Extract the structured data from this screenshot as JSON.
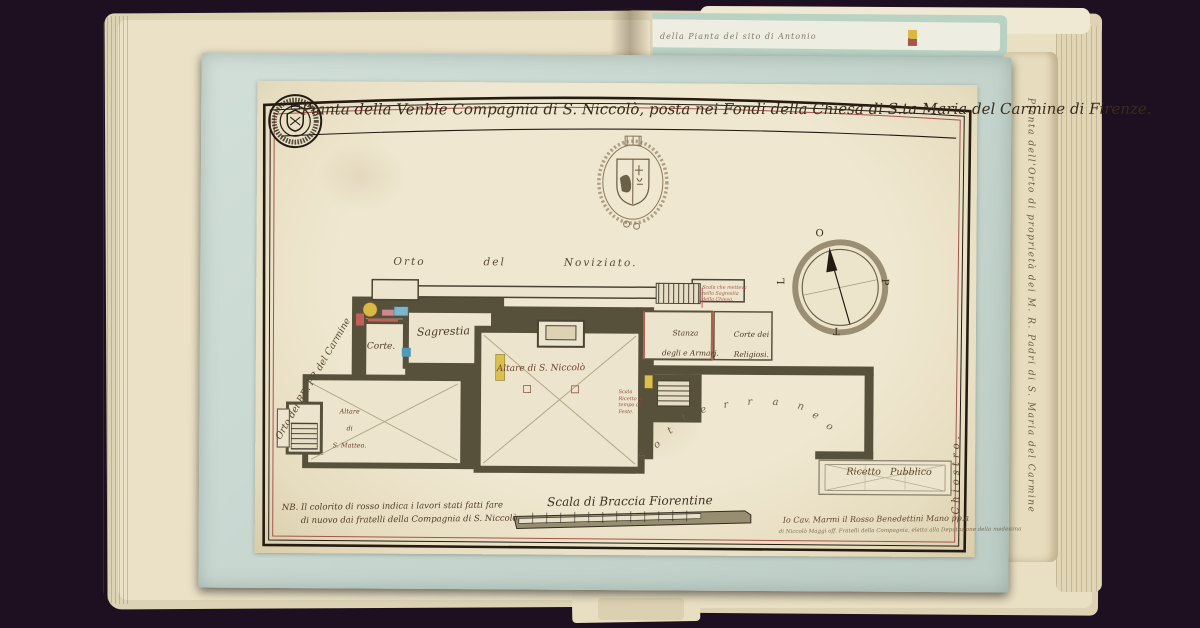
{
  "artwork": {
    "title": "Pianta della Venble Compagnia di S. Niccolò, posta nei Fondi della Chiesa di S.ta Maria del Carmine di Firenze."
  },
  "plan": {
    "rooms": {
      "sagrestia": "Sagrestia",
      "corte": "Corte.",
      "altare_niccolo": "Altare di S. Niccolò",
      "altare_matteo": [
        "Altare",
        "di",
        "S. Matteo."
      ],
      "stanza_armarj": [
        "Stanza",
        "degli e Armarj."
      ],
      "corte_religiosi": [
        "Corte dei",
        "Religiosi."
      ],
      "ricetto_pubblico": "Ricetto   Pubblico"
    },
    "areas": {
      "orto_noviziato": "Orto   del   Noviziato.",
      "orto_carmine": "Orto dei RR. PP. del Carmine",
      "sotterraneo": "Sotterraneo",
      "chiostro": "Chiostro."
    },
    "notes": {
      "scala_sagrestia": [
        "Scala che metteva",
        "nella Sagrestia",
        "della Chiesa."
      ],
      "ricetto_feste": [
        "Scala",
        "Ricetto in",
        "tempo di",
        "Feste."
      ]
    }
  },
  "compass": {
    "top": "O",
    "right": "P",
    "bottom": "T",
    "left": "L"
  },
  "footer": {
    "scale_label": "Scala di Braccia Fiorentine",
    "nb_line1": "NB. Il colorito di rosso indica i lavori stati fatti fare",
    "nb_line2": "di nuovo dai fratelli della Compagnia di S. Niccolò.",
    "signature_line1": "Io Cav. Marmi il Rosso Benedettini Mano pp.a",
    "signature_line2": "di Niccolò Maggi off. Fratelli della Compagnia, eletto alla Deputazione della medesima"
  },
  "book": {
    "side_page_text": "Pianta dell'Orto di proprietà dei M. R. Padri di S. Maria del Carmine",
    "top_page_text": "della Pianta del sito di Antonio"
  },
  "colors": {
    "background": "#1e1020",
    "plate_blue": "#c9d8d2",
    "paper_cream": "#e9e1c9",
    "wall_poche": "#57503b",
    "ink": "#2c2318",
    "accent_red": "#a8544b",
    "accent_yellow": "#d9b945",
    "accent_blue": "#6fa9bf"
  }
}
